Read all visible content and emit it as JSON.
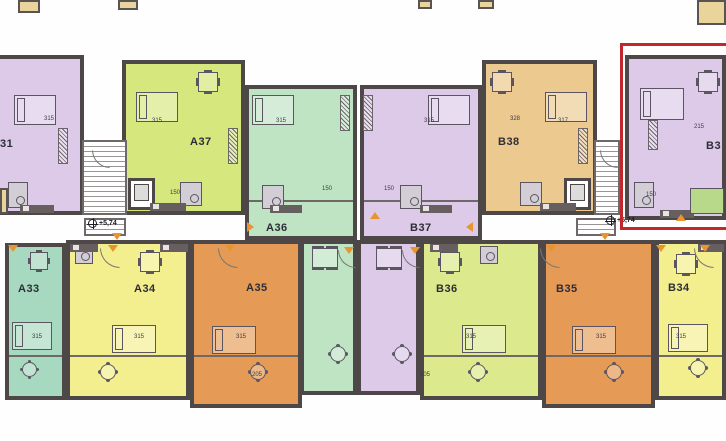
{
  "plan": {
    "description": "Residential building floor plan, level +5,74, entrances A and B",
    "wall_color": "#4e4747",
    "highlight_color": "#c1272d",
    "marker_color": "#e8952f",
    "units": [
      {
        "id": "unit-31-partial",
        "label": "31",
        "color": "#dccae8",
        "label_x": 0,
        "label_y": 138,
        "rects": [
          [
            -6,
            55,
            90,
            160
          ]
        ]
      },
      {
        "id": "unit-a37",
        "label": "A37",
        "color": "#d6e77d",
        "label_x": 190,
        "label_y": 136,
        "rects": [
          [
            122,
            60,
            123,
            155
          ]
        ]
      },
      {
        "id": "unit-a36",
        "label": "A36",
        "color": "#bfe4c4",
        "label_x": 266,
        "label_y": 222,
        "rects": [
          [
            245,
            85,
            112,
            155
          ],
          [
            300,
            240,
            57,
            155
          ]
        ]
      },
      {
        "id": "unit-b37",
        "label": "B37",
        "color": "#dccae8",
        "label_x": 410,
        "label_y": 222,
        "rects": [
          [
            360,
            85,
            122,
            155
          ],
          [
            357,
            240,
            63,
            155
          ]
        ]
      },
      {
        "id": "unit-b38",
        "label": "B38",
        "color": "#ecc98f",
        "label_x": 498,
        "label_y": 136,
        "rects": [
          [
            482,
            60,
            115,
            155
          ]
        ]
      },
      {
        "id": "unit-b39-highlighted",
        "label": "B3",
        "color": "#dccae8",
        "label_x": 706,
        "label_y": 140,
        "rects": [
          [
            625,
            55,
            101,
            165
          ]
        ]
      },
      {
        "id": "unit-a33",
        "label": "A33",
        "color": "#a6d9bf",
        "label_x": 18,
        "label_y": 283,
        "rects": [
          [
            5,
            243,
            61,
            157
          ]
        ]
      },
      {
        "id": "unit-a34",
        "label": "A34",
        "color": "#f4ef8e",
        "label_x": 134,
        "label_y": 283,
        "rects": [
          [
            66,
            240,
            124,
            160
          ]
        ]
      },
      {
        "id": "unit-a35",
        "label": "A35",
        "color": "#e59a55",
        "label_x": 246,
        "label_y": 282,
        "rects": [
          [
            190,
            240,
            112,
            168
          ]
        ]
      },
      {
        "id": "unit-b36",
        "label": "B36",
        "color": "#dcea8d",
        "label_x": 436,
        "label_y": 283,
        "rects": [
          [
            420,
            240,
            122,
            160
          ]
        ]
      },
      {
        "id": "unit-b35",
        "label": "B35",
        "color": "#e59a55",
        "label_x": 556,
        "label_y": 283,
        "rects": [
          [
            542,
            240,
            113,
            168
          ]
        ]
      },
      {
        "id": "unit-b34",
        "label": "B34",
        "color": "#f4ef8e",
        "label_x": 668,
        "label_y": 282,
        "rects": [
          [
            655,
            240,
            71,
            160
          ]
        ]
      }
    ],
    "elevation_markers": [
      {
        "label": "+5,74",
        "x": 88,
        "y": 219
      },
      {
        "label": "+5,74",
        "x": 606,
        "y": 216
      }
    ],
    "highlight_box": [
      620,
      43,
      114,
      187
    ],
    "stairwells": [
      [
        82,
        140,
        45,
        75
      ],
      [
        594,
        140,
        26,
        75
      ],
      [
        84,
        218,
        42,
        18
      ],
      [
        576,
        218,
        40,
        18
      ]
    ],
    "elevators": [
      [
        128,
        178,
        27,
        32
      ],
      [
        564,
        178,
        27,
        32
      ]
    ],
    "wall_lines": [
      [
        9,
        355,
        53
      ],
      [
        70,
        355,
        116
      ],
      [
        194,
        355,
        104
      ],
      [
        424,
        355,
        114
      ],
      [
        546,
        355,
        105
      ],
      [
        659,
        355,
        63
      ],
      [
        249,
        200,
        104
      ],
      [
        364,
        200,
        114
      ]
    ],
    "dims": [
      {
        "t": "315",
        "x": 44,
        "y": 116
      },
      {
        "t": "315",
        "x": 152,
        "y": 118
      },
      {
        "t": "315",
        "x": 276,
        "y": 118
      },
      {
        "t": "315",
        "x": 424,
        "y": 118
      },
      {
        "t": "328",
        "x": 510,
        "y": 116
      },
      {
        "t": "317",
        "x": 558,
        "y": 118
      },
      {
        "t": "215",
        "x": 694,
        "y": 124
      },
      {
        "t": "315",
        "x": 32,
        "y": 334
      },
      {
        "t": "315",
        "x": 134,
        "y": 334
      },
      {
        "t": "315",
        "x": 236,
        "y": 334
      },
      {
        "t": "315",
        "x": 466,
        "y": 334
      },
      {
        "t": "315",
        "x": 596,
        "y": 334
      },
      {
        "t": "315",
        "x": 676,
        "y": 334
      },
      {
        "t": "150",
        "x": 170,
        "y": 190
      },
      {
        "t": "150",
        "x": 322,
        "y": 186
      },
      {
        "t": "150",
        "x": 384,
        "y": 186
      },
      {
        "t": "150",
        "x": 646,
        "y": 192
      },
      {
        "t": "205",
        "x": 252,
        "y": 372
      },
      {
        "t": "205",
        "x": 420,
        "y": 372
      }
    ],
    "triangles": [
      {
        "x": 112,
        "y": 233,
        "dir": "down"
      },
      {
        "x": 600,
        "y": 233,
        "dir": "down"
      },
      {
        "x": 8,
        "y": 245,
        "dir": "down"
      },
      {
        "x": 108,
        "y": 245,
        "dir": "down"
      },
      {
        "x": 225,
        "y": 245,
        "dir": "down"
      },
      {
        "x": 344,
        "y": 247,
        "dir": "down"
      },
      {
        "x": 410,
        "y": 247,
        "dir": "down"
      },
      {
        "x": 546,
        "y": 245,
        "dir": "down"
      },
      {
        "x": 656,
        "y": 245,
        "dir": "down"
      },
      {
        "x": 700,
        "y": 245,
        "dir": "down"
      },
      {
        "x": 676,
        "y": 214,
        "dir": "up"
      },
      {
        "x": 370,
        "y": 212,
        "dir": "up"
      },
      {
        "x": 247,
        "y": 222,
        "dir": "right"
      },
      {
        "x": 466,
        "y": 222,
        "dir": "left"
      }
    ],
    "fragments": [
      [
        18,
        0,
        22,
        13
      ],
      [
        118,
        0,
        20,
        10
      ],
      [
        418,
        0,
        14,
        9
      ],
      [
        478,
        0,
        16,
        9
      ],
      [
        697,
        0,
        29,
        25
      ],
      [
        0,
        188,
        8,
        26
      ]
    ],
    "furniture": [
      {
        "type": "bed",
        "x": 14,
        "y": 95,
        "w": 42,
        "h": 30
      },
      {
        "type": "bed",
        "x": 136,
        "y": 92,
        "w": 42,
        "h": 30
      },
      {
        "type": "bed",
        "x": 252,
        "y": 95,
        "w": 42,
        "h": 30
      },
      {
        "type": "bed",
        "x": 428,
        "y": 95,
        "w": 42,
        "h": 30
      },
      {
        "type": "bed",
        "x": 545,
        "y": 92,
        "w": 42,
        "h": 30
      },
      {
        "type": "bed",
        "x": 640,
        "y": 88,
        "w": 44,
        "h": 32
      },
      {
        "type": "bed",
        "x": 12,
        "y": 322,
        "w": 40,
        "h": 28
      },
      {
        "type": "bed",
        "x": 112,
        "y": 325,
        "w": 44,
        "h": 28
      },
      {
        "type": "bed",
        "x": 212,
        "y": 326,
        "w": 44,
        "h": 28
      },
      {
        "type": "bed",
        "x": 462,
        "y": 325,
        "w": 44,
        "h": 28
      },
      {
        "type": "bed",
        "x": 572,
        "y": 326,
        "w": 44,
        "h": 28
      },
      {
        "type": "bed",
        "x": 668,
        "y": 324,
        "w": 40,
        "h": 28
      },
      {
        "type": "table",
        "x": 198,
        "y": 72,
        "w": 20,
        "h": 20
      },
      {
        "type": "table",
        "x": 492,
        "y": 72,
        "w": 20,
        "h": 20
      },
      {
        "type": "table",
        "x": 698,
        "y": 72,
        "w": 20,
        "h": 20
      },
      {
        "type": "table",
        "x": 30,
        "y": 252,
        "w": 18,
        "h": 18
      },
      {
        "type": "table",
        "x": 140,
        "y": 252,
        "w": 20,
        "h": 20
      },
      {
        "type": "table",
        "x": 440,
        "y": 252,
        "w": 20,
        "h": 20
      },
      {
        "type": "table",
        "x": 676,
        "y": 254,
        "w": 20,
        "h": 20
      },
      {
        "type": "table6",
        "x": 312,
        "y": 248,
        "w": 26,
        "h": 20
      },
      {
        "type": "table6",
        "x": 376,
        "y": 248,
        "w": 26,
        "h": 20
      },
      {
        "type": "rtable",
        "x": 22,
        "y": 362,
        "w": 15,
        "h": 15
      },
      {
        "type": "rtable",
        "x": 100,
        "y": 364,
        "w": 16,
        "h": 16
      },
      {
        "type": "rtable",
        "x": 250,
        "y": 364,
        "w": 16,
        "h": 16
      },
      {
        "type": "rtable",
        "x": 330,
        "y": 346,
        "w": 16,
        "h": 16
      },
      {
        "type": "rtable",
        "x": 394,
        "y": 346,
        "w": 16,
        "h": 16
      },
      {
        "type": "rtable",
        "x": 470,
        "y": 364,
        "w": 16,
        "h": 16
      },
      {
        "type": "rtable",
        "x": 606,
        "y": 364,
        "w": 16,
        "h": 16
      },
      {
        "type": "rtable",
        "x": 690,
        "y": 360,
        "w": 16,
        "h": 16
      },
      {
        "type": "bath",
        "x": 8,
        "y": 182,
        "w": 20,
        "h": 26
      },
      {
        "type": "bath",
        "x": 180,
        "y": 182,
        "w": 22,
        "h": 24
      },
      {
        "type": "bath",
        "x": 262,
        "y": 185,
        "w": 22,
        "h": 24
      },
      {
        "type": "bath",
        "x": 400,
        "y": 185,
        "w": 22,
        "h": 24
      },
      {
        "type": "bath",
        "x": 520,
        "y": 182,
        "w": 22,
        "h": 24
      },
      {
        "type": "bath",
        "x": 634,
        "y": 182,
        "w": 20,
        "h": 26
      },
      {
        "type": "bath",
        "x": 75,
        "y": 246,
        "w": 18,
        "h": 18
      },
      {
        "type": "bath",
        "x": 480,
        "y": 246,
        "w": 18,
        "h": 18
      },
      {
        "type": "kitchen",
        "x": 20,
        "y": 205,
        "w": 34,
        "h": 8
      },
      {
        "type": "kitchen",
        "x": 150,
        "y": 203,
        "w": 36,
        "h": 8
      },
      {
        "type": "kitchen",
        "x": 270,
        "y": 205,
        "w": 32,
        "h": 8
      },
      {
        "type": "kitchen",
        "x": 420,
        "y": 205,
        "w": 32,
        "h": 8
      },
      {
        "type": "kitchen",
        "x": 540,
        "y": 203,
        "w": 36,
        "h": 8
      },
      {
        "type": "kitchen",
        "x": 660,
        "y": 210,
        "w": 34,
        "h": 8
      },
      {
        "type": "kitchen",
        "x": 70,
        "y": 244,
        "w": 28,
        "h": 8
      },
      {
        "type": "kitchen",
        "x": 160,
        "y": 244,
        "w": 28,
        "h": 8
      },
      {
        "type": "kitchen",
        "x": 430,
        "y": 244,
        "w": 28,
        "h": 8
      },
      {
        "type": "kitchen",
        "x": 698,
        "y": 244,
        "w": 26,
        "h": 8
      },
      {
        "type": "wardrobe",
        "x": 58,
        "y": 128,
        "w": 10,
        "h": 36
      },
      {
        "type": "wardrobe",
        "x": 228,
        "y": 128,
        "w": 10,
        "h": 36
      },
      {
        "type": "wardrobe",
        "x": 340,
        "y": 95,
        "w": 10,
        "h": 36
      },
      {
        "type": "wardrobe",
        "x": 363,
        "y": 95,
        "w": 10,
        "h": 36
      },
      {
        "type": "wardrobe",
        "x": 578,
        "y": 128,
        "w": 10,
        "h": 36
      },
      {
        "type": "wardrobe",
        "x": 648,
        "y": 120,
        "w": 10,
        "h": 30
      },
      {
        "type": "sofa",
        "x": 690,
        "y": 188,
        "w": 34,
        "h": 26
      }
    ],
    "arcs": [
      [
        100,
        248,
        18,
        18
      ],
      [
        218,
        248,
        18,
        18
      ],
      [
        338,
        250,
        16,
        16
      ],
      [
        402,
        250,
        16,
        16
      ],
      [
        540,
        248,
        18,
        18
      ],
      [
        694,
        248,
        18,
        18
      ],
      [
        92,
        150,
        16,
        16
      ],
      [
        600,
        150,
        16,
        16
      ]
    ]
  }
}
